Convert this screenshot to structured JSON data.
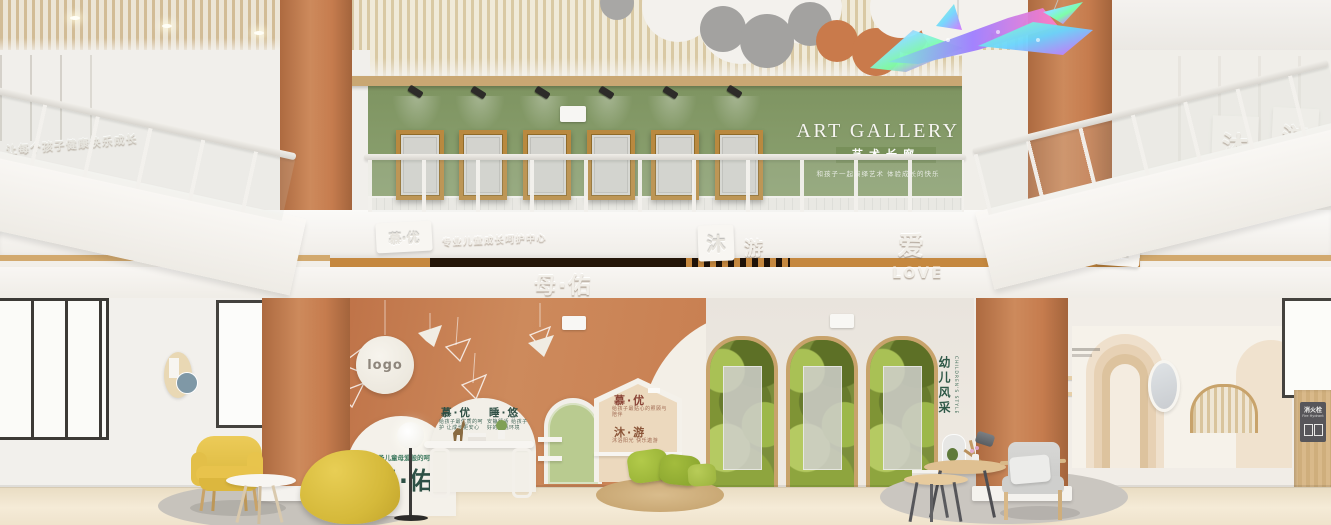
{
  "colors": {
    "terracotta": "#C9855A",
    "sage_green": "#8AA06E",
    "copper_trim": "#C5883F",
    "accent_yellow": "#E3C04A",
    "leaf_green": "#9CB83C",
    "brand_dark_green": "#2E5248",
    "brand_dark_red": "#8A4437"
  },
  "upper": {
    "gallery_title": "ART GALLERY",
    "gallery_subtitle": "艺术长廊",
    "gallery_tagline": "和孩子一起演绎艺术 体验成长的快乐",
    "left_wall_relief": "让每个孩子健康快乐成长",
    "right_wall_char_1": "沐",
    "right_wall_char_2": "游",
    "frame_count": "6"
  },
  "fascia": {
    "left_badge": "慕·优",
    "left_caption": "专业儿童成长呵护中心",
    "center_char_1": "沐",
    "center_char_2": "游",
    "love_char": "爱",
    "love_word": "LOVE",
    "brand_center": "母·佑",
    "right_relief": "教育",
    "right_caption": "个性化成长教育",
    "right_badge": "个性"
  },
  "lobby": {
    "logo_text": "logo",
    "dome": {
      "title_1": "慕·优",
      "caption_1": "给孩子最优质的呵护 让成长更安心",
      "title_2": "睡·悠",
      "caption_2": "安静舒适 给孩子好的睡眠环境"
    },
    "house": {
      "title_1": "慕·优",
      "caption_1": "给孩子最贴心的照顾与陪伴",
      "title_2": "沐·游",
      "caption_2": "沐浴阳光 快乐遨游"
    },
    "mother_caption": "给予儿童母爱般的呵护",
    "mother_title": "母·佑",
    "children_style_cn": "幼儿风采",
    "children_style_en": "CHILDREN'S STYLE",
    "fire_hydrant_cn": "消火栓",
    "fire_hydrant_en": "Fire Hydrant",
    "arch_niche_count": "3"
  }
}
